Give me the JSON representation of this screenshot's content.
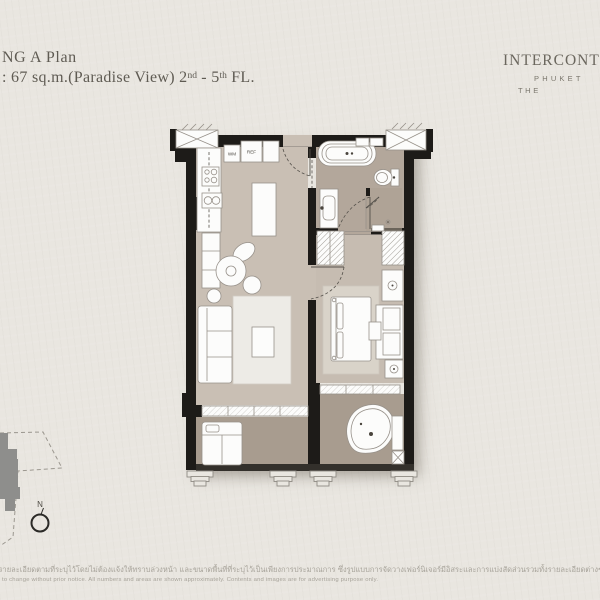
{
  "header": {
    "title_fragment": "NG A Plan",
    "subtitle_prefix": ": 67 sq.m.(Paradise View) 2",
    "subtitle_sup1": "nd",
    "subtitle_mid": " - 5",
    "subtitle_sup2": "th",
    "subtitle_suffix": " FL."
  },
  "brand": {
    "name": "INTERCONTINENTAL",
    "location": "PHUKET",
    "tagline": "THE"
  },
  "plan": {
    "labels": {
      "washing_machine": "WM",
      "refrigerator": "REF"
    }
  },
  "compass": {
    "north_label": "N"
  },
  "footer": {
    "thai_line": "อรายละเอียดตามที่ระบุไว้โดยไม่ต้องแจ้งให้ทราบล่วงหน้า และขนาดพื้นที่ที่ระบุไว้เป็นเพียงการประมาณการ ซึ่งรูปแบบการจัดวางเฟอร์นิเจอร์มีอิสระและการแบ่งสัดส่วนรวมทั้งรายละเอียดต่างๆเป็นเพียงการแสดงตัวอย่างการจัดวาง",
    "english_line": "to change without prior notice. All numbers and areas are shown approximately. Contents and images are for advertising purpose only."
  },
  "palette": {
    "paper": "#e9e6e0",
    "wall": "#1d1b18",
    "floor_living": "#c9bfb4",
    "floor_bedroom": "#c6bcb1",
    "floor_bathroom": "#b3a79b",
    "floor_balcony": "#a89c8f",
    "rug_living": "#edebe6",
    "rug_bedroom": "#d9d3c9",
    "text_header": "#5f5b53",
    "text_disclaimer": "#a7a39a"
  }
}
